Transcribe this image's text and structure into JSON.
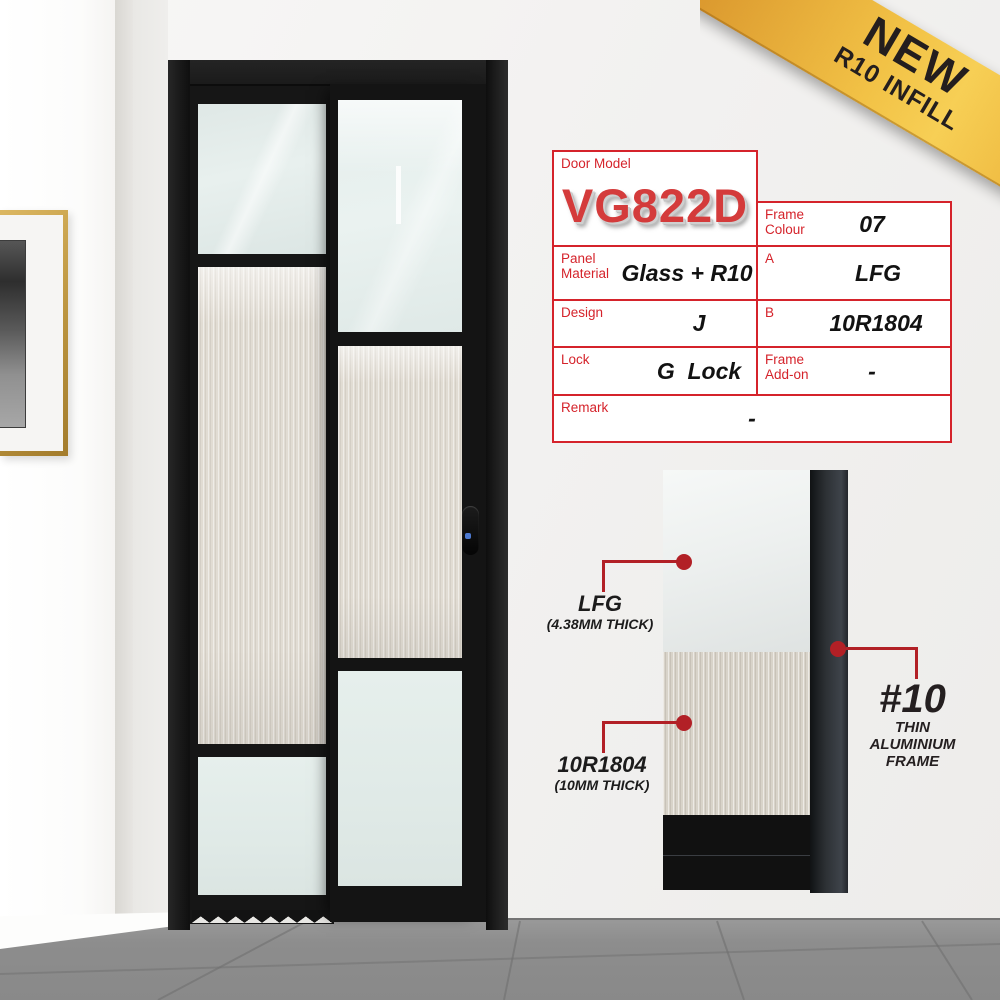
{
  "badge": {
    "line1": "NEW",
    "line2": "R10 INFILL"
  },
  "spec_table": {
    "door_model": {
      "label": "Door Model",
      "value": "VG822D"
    },
    "frame_colour": {
      "label": "Frame Colour",
      "value": "07"
    },
    "panel_material": {
      "label": "Panel Material",
      "value": "Glass + R10"
    },
    "a": {
      "label": "A",
      "value": "LFG"
    },
    "design": {
      "label": "Design",
      "value": "J"
    },
    "b": {
      "label": "B",
      "value": "10R1804"
    },
    "lock": {
      "label": "Lock",
      "value": "G  Lock"
    },
    "frame_addon": {
      "label": "Frame Add-on",
      "value": "-"
    },
    "remark": {
      "label": "Remark",
      "value": "-"
    }
  },
  "callouts": {
    "glass": {
      "title": "LFG",
      "subtitle": "(4.38MM THICK)"
    },
    "infill": {
      "title": "10R1804",
      "subtitle": "(10MM THICK)"
    },
    "frame": {
      "title": "#10",
      "line1": "THIN",
      "line2": "ALUMINIUM",
      "line3": "FRAME"
    }
  },
  "colors": {
    "table_border_red": "#d5232b",
    "model_red": "#d43b3b",
    "callout_red": "#b22026",
    "ribbon_gold": "#f2c246",
    "door_black": "#1a1a1a",
    "floor_grey": "#8d8d8d"
  }
}
